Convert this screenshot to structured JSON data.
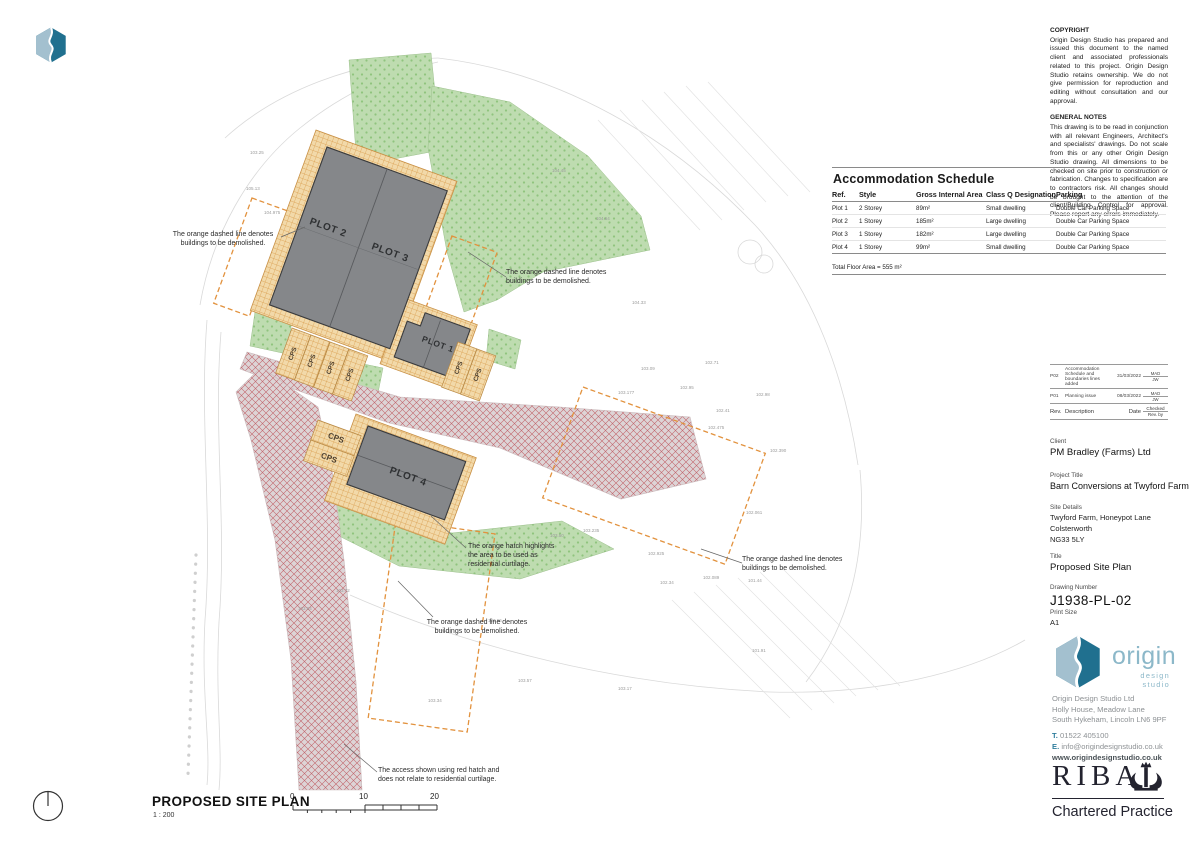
{
  "colors": {
    "brand_teal": "#2e7d9c",
    "brand_light_blue": "#a3c0cf",
    "demolition_orange": "#e2923e",
    "curtilage_orange": "#e8b264",
    "building_grey": "#85878a",
    "landscape_green": "#b9d8aa",
    "access_red": "#c2666d"
  },
  "notes": {
    "copyright_title": "COPYRIGHT",
    "copyright_body": "Origin Design Studio has prepared and issued this document to the named client and associated professionals related to this project. Origin Design Studio retains ownership. We do not give permission for reproduction and editing without consultation and our approval.",
    "general_title": "GENERAL NOTES",
    "general_body": "This drawing is to be read in conjunction with all relevant Engineers, Architect's and specialists' drawings. Do not scale from this or any other Origin Design Studio drawing. All dimensions to be checked on site prior to construction or fabrication. Changes to specification are to contractors risk. All changes should be brought to the attention of the client/Building Control for approval. Please report any errors immediately."
  },
  "schedule": {
    "title": "Accommodation Schedule",
    "columns": [
      "Ref.",
      "Style",
      "Gross Internal Area",
      "Class Q Designation",
      "Parking"
    ],
    "rows": [
      {
        "ref": "Plot 1",
        "style": "2 Storey",
        "area": "89m²",
        "designation": "Small dwelling",
        "parking": "Double Car Parking Space"
      },
      {
        "ref": "Plot 2",
        "style": "1 Storey",
        "area": "185m²",
        "designation": "Large dwelling",
        "parking": "Double Car Parking Space"
      },
      {
        "ref": "Plot 3",
        "style": "1 Storey",
        "area": "182m²",
        "designation": "Large dwelling",
        "parking": "Double Car Parking Space"
      },
      {
        "ref": "Plot 4",
        "style": "1 Storey",
        "area": "99m²",
        "designation": "Small dwelling",
        "parking": "Double Car Parking Space"
      }
    ],
    "total": "Total Floor Area = 555 m²"
  },
  "revisions": {
    "header": {
      "rev": "Rev.",
      "description": "Description",
      "date": "Date",
      "checked": "Checked",
      "by": "Rev. by"
    },
    "rows": [
      {
        "rev": "P02",
        "description": "Accommodation Schedule and boundaries lines added",
        "date": "31/03/2022",
        "checked": "MAD",
        "by": "JW"
      },
      {
        "rev": "P01",
        "description": "Planning issue",
        "date": "08/03/2022",
        "checked": "MAD",
        "by": "JW"
      }
    ]
  },
  "titleblock": {
    "client_label": "Client",
    "client": "PM Bradley (Farms) Ltd",
    "project_label": "Project Title",
    "project": "Barn Conversions at Twyford Farm",
    "site_label": "Site Details",
    "site_line1": "Twyford Farm, Honeypot Lane",
    "site_line2": "Colsterworth",
    "site_line3": "NG33 5LY",
    "title_label": "Title",
    "title": "Proposed Site Plan",
    "number_label": "Drawing Number",
    "number": "J1938-PL-02",
    "size_label": "Print Size",
    "size": "A1"
  },
  "studio": {
    "wordmark": "origin",
    "tagline": "design studio",
    "name": "Origin Design Studio Ltd",
    "address1": "Holly House, Meadow Lane",
    "address2": "South Hykeham, Lincoln LN6 9PF",
    "tel_label": "T.",
    "tel": "01522 405100",
    "email_label": "E.",
    "email": "info@origindesignstudio.co.uk",
    "web": "www.origindesignstudio.co.uk"
  },
  "riba": {
    "wordmark": "RIBA",
    "subtitle": "Chartered Practice"
  },
  "footer": {
    "plan_title": "PROPOSED SITE PLAN",
    "scale": "1 : 200",
    "tick0": "0",
    "tick1": "10",
    "tick2": "20"
  },
  "plan": {
    "plots": {
      "p1": "PLOT 1",
      "p2": "PLOT 2",
      "p3": "PLOT 3",
      "p4": "PLOT 4"
    },
    "cps": "CPS",
    "annotations": {
      "demolish": "The orange dashed line denotes buildings to be demolished.",
      "curtilage": "The orange hatch highlights the area to be used as residential curtilage.",
      "access": "The access shown using red hatch and does not relate to residential curtilage."
    },
    "spot_levels": [
      {
        "v": "103.25",
        "x": 250,
        "y": 150
      },
      {
        "v": "105.13",
        "x": 246,
        "y": 186
      },
      {
        "v": "104.975",
        "x": 264,
        "y": 210
      },
      {
        "v": "104.45",
        "x": 552,
        "y": 168
      },
      {
        "v": "104.64",
        "x": 596,
        "y": 216
      },
      {
        "v": "104.33",
        "x": 632,
        "y": 300
      },
      {
        "v": "103.09",
        "x": 641,
        "y": 366
      },
      {
        "v": "102.71",
        "x": 705,
        "y": 360
      },
      {
        "v": "102.95",
        "x": 680,
        "y": 385
      },
      {
        "v": "102.98",
        "x": 756,
        "y": 392
      },
      {
        "v": "102.41",
        "x": 716,
        "y": 408
      },
      {
        "v": "103.177",
        "x": 618,
        "y": 390
      },
      {
        "v": "102.475",
        "x": 708,
        "y": 425
      },
      {
        "v": "102.390",
        "x": 770,
        "y": 448
      },
      {
        "v": "102.061",
        "x": 746,
        "y": 510
      },
      {
        "v": "103.235",
        "x": 583,
        "y": 528
      },
      {
        "v": "102.925",
        "x": 648,
        "y": 551
      },
      {
        "v": "103.50",
        "x": 550,
        "y": 533
      },
      {
        "v": "102.089",
        "x": 703,
        "y": 575
      },
      {
        "v": "102.34",
        "x": 660,
        "y": 580
      },
      {
        "v": "101.44",
        "x": 748,
        "y": 578
      },
      {
        "v": "103.57",
        "x": 518,
        "y": 678
      },
      {
        "v": "103.17",
        "x": 618,
        "y": 686
      },
      {
        "v": "103.34",
        "x": 428,
        "y": 698
      },
      {
        "v": "103.94",
        "x": 298,
        "y": 606
      },
      {
        "v": "103.72",
        "x": 336,
        "y": 588
      },
      {
        "v": "103.66",
        "x": 488,
        "y": 618
      },
      {
        "v": "101.91",
        "x": 752,
        "y": 648
      }
    ]
  }
}
